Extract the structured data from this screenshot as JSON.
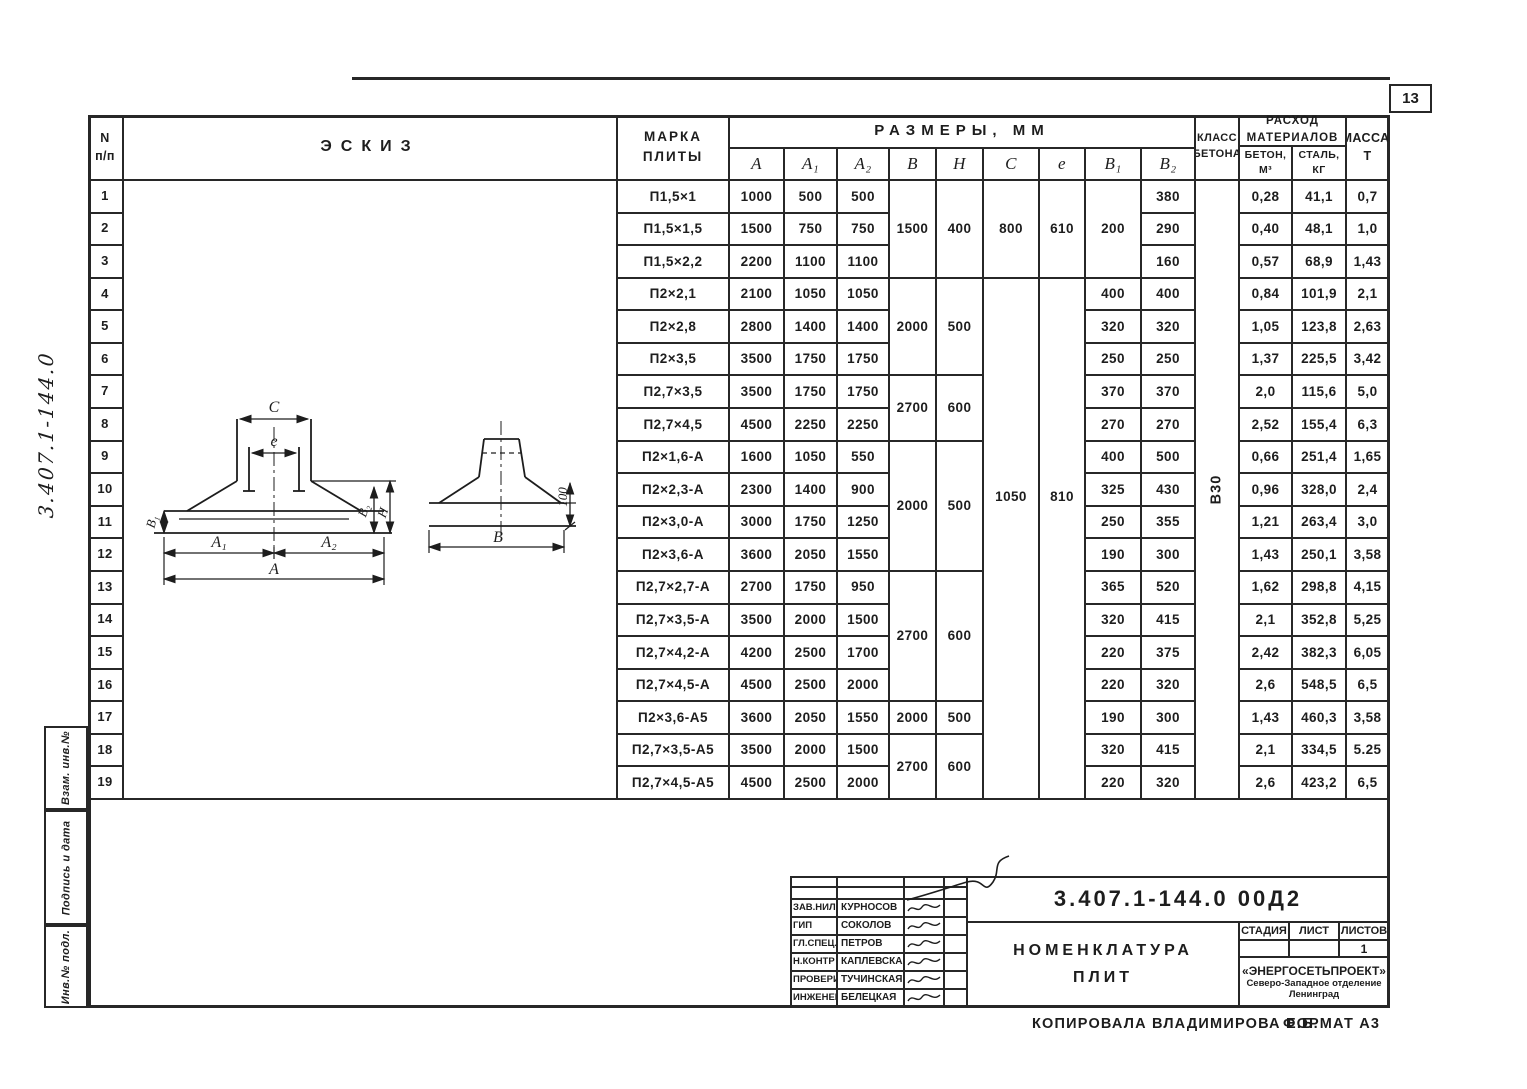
{
  "page": {
    "number": "13",
    "side_code": "3.407.1-144.0",
    "stamps": [
      "Взам. инв.№",
      "Подпись и дата",
      "Инв.№ подл."
    ],
    "copied": "КОПИРОВАЛА  ВЛАДИМИРОВА Е.Б.",
    "format": "ФОРМАТ А3"
  },
  "table": {
    "headers": {
      "num": [
        "N",
        "п/п"
      ],
      "sketch": "ЭСКИЗ",
      "mark": [
        "МАРКА",
        "ПЛИТЫ"
      ],
      "sizes_group": "РАЗМЕРЫ,  ММ",
      "size_cols": [
        "A",
        "A₁",
        "A₂",
        "B",
        "H",
        "C",
        "e",
        "B₁",
        "B₂"
      ],
      "class_col": [
        "КЛАСС",
        "БЕТОНА"
      ],
      "materials_group": [
        "РАСХОД",
        "МАТЕРИАЛОВ"
      ],
      "concrete_sub": [
        "БЕТОН,",
        "М³"
      ],
      "steel_sub": [
        "СТАЛЬ,",
        "КГ"
      ],
      "mass_col": [
        "МАССА,",
        "Т"
      ]
    },
    "rows": [
      {
        "n": "1",
        "mark": "П1,5×1",
        "a": "1000",
        "a1": "500",
        "a2": "500",
        "b2": "380",
        "concrete": "0,28",
        "steel": "41,1",
        "mass": "0,7"
      },
      {
        "n": "2",
        "mark": "П1,5×1,5",
        "a": "1500",
        "a1": "750",
        "a2": "750",
        "b2": "290",
        "concrete": "0,40",
        "steel": "48,1",
        "mass": "1,0"
      },
      {
        "n": "3",
        "mark": "П1,5×2,2",
        "a": "2200",
        "a1": "1100",
        "a2": "1100",
        "b2": "160",
        "concrete": "0,57",
        "steel": "68,9",
        "mass": "1,43"
      },
      {
        "n": "4",
        "mark": "П2×2,1",
        "a": "2100",
        "a1": "1050",
        "a2": "1050",
        "b1": "400",
        "b2": "400",
        "concrete": "0,84",
        "steel": "101,9",
        "mass": "2,1"
      },
      {
        "n": "5",
        "mark": "П2×2,8",
        "a": "2800",
        "a1": "1400",
        "a2": "1400",
        "b1": "320",
        "b2": "320",
        "concrete": "1,05",
        "steel": "123,8",
        "mass": "2,63"
      },
      {
        "n": "6",
        "mark": "П2×3,5",
        "a": "3500",
        "a1": "1750",
        "a2": "1750",
        "b1": "250",
        "b2": "250",
        "concrete": "1,37",
        "steel": "225,5",
        "mass": "3,42"
      },
      {
        "n": "7",
        "mark": "П2,7×3,5",
        "a": "3500",
        "a1": "1750",
        "a2": "1750",
        "b1": "370",
        "b2": "370",
        "concrete": "2,0",
        "steel": "115,6",
        "mass": "5,0"
      },
      {
        "n": "8",
        "mark": "П2,7×4,5",
        "a": "4500",
        "a1": "2250",
        "a2": "2250",
        "b1": "270",
        "b2": "270",
        "concrete": "2,52",
        "steel": "155,4",
        "mass": "6,3"
      },
      {
        "n": "9",
        "mark": "П2×1,6-А",
        "a": "1600",
        "a1": "1050",
        "a2": "550",
        "b1": "400",
        "b2": "500",
        "concrete": "0,66",
        "steel": "251,4",
        "mass": "1,65"
      },
      {
        "n": "10",
        "mark": "П2×2,3-А",
        "a": "2300",
        "a1": "1400",
        "a2": "900",
        "b1": "325",
        "b2": "430",
        "concrete": "0,96",
        "steel": "328,0",
        "mass": "2,4"
      },
      {
        "n": "11",
        "mark": "П2×3,0-А",
        "a": "3000",
        "a1": "1750",
        "a2": "1250",
        "b1": "250",
        "b2": "355",
        "concrete": "1,21",
        "steel": "263,4",
        "mass": "3,0"
      },
      {
        "n": "12",
        "mark": "П2×3,6-А",
        "a": "3600",
        "a1": "2050",
        "a2": "1550",
        "b1": "190",
        "b2": "300",
        "concrete": "1,43",
        "steel": "250,1",
        "mass": "3,58"
      },
      {
        "n": "13",
        "mark": "П2,7×2,7-А",
        "a": "2700",
        "a1": "1750",
        "a2": "950",
        "b1": "365",
        "b2": "520",
        "concrete": "1,62",
        "steel": "298,8",
        "mass": "4,15"
      },
      {
        "n": "14",
        "mark": "П2,7×3,5-А",
        "a": "3500",
        "a1": "2000",
        "a2": "1500",
        "b1": "320",
        "b2": "415",
        "concrete": "2,1",
        "steel": "352,8",
        "mass": "5,25"
      },
      {
        "n": "15",
        "mark": "П2,7×4,2-А",
        "a": "4200",
        "a1": "2500",
        "a2": "1700",
        "b1": "220",
        "b2": "375",
        "concrete": "2,42",
        "steel": "382,3",
        "mass": "6,05"
      },
      {
        "n": "16",
        "mark": "П2,7×4,5-А",
        "a": "4500",
        "a1": "2500",
        "a2": "2000",
        "b1": "220",
        "b2": "320",
        "concrete": "2,6",
        "steel": "548,5",
        "mass": "6,5"
      },
      {
        "n": "17",
        "mark": "П2×3,6-А5",
        "a": "3600",
        "a1": "2050",
        "a2": "1550",
        "b1": "190",
        "b2": "300",
        "concrete": "1,43",
        "steel": "460,3",
        "mass": "3,58"
      },
      {
        "n": "18",
        "mark": "П2,7×3,5-А5",
        "a": "3500",
        "a1": "2000",
        "a2": "1500",
        "b1": "320",
        "b2": "415",
        "concrete": "2,1",
        "steel": "334,5",
        "mass": "5.25"
      },
      {
        "n": "19",
        "mark": "П2,7×4,5-А5",
        "a": "4500",
        "a1": "2500",
        "a2": "2000",
        "b1": "220",
        "b2": "320",
        "concrete": "2,6",
        "steel": "423,2",
        "mass": "6,5"
      }
    ],
    "merged": {
      "bh_groups": [
        {
          "from": 1,
          "to": 3,
          "b": "1500",
          "h": "400"
        },
        {
          "from": 4,
          "to": 6,
          "b": "2000",
          "h": "500"
        },
        {
          "from": 7,
          "to": 8,
          "b": "2700",
          "h": "600"
        },
        {
          "from": 9,
          "to": 12,
          "b": "2000",
          "h": "500"
        },
        {
          "from": 13,
          "to": 16,
          "b": "2700",
          "h": "600"
        },
        {
          "from": 17,
          "to": 17,
          "b": "2000",
          "h": "500"
        },
        {
          "from": 18,
          "to": 19,
          "b": "2700",
          "h": "600"
        }
      ],
      "ce_groups": [
        {
          "from": 1,
          "to": 3,
          "c": "800",
          "e": "610"
        },
        {
          "from": 4,
          "to": 19,
          "c": "1050",
          "e": "810",
          "pad": 0.4
        }
      ],
      "b1_group": {
        "from": 1,
        "to": 3,
        "value": "200"
      },
      "concrete_class": "В30"
    }
  },
  "sketch_labels": {
    "c": "C",
    "e": "e",
    "b1": "B₁",
    "b2": "B₂",
    "h": "H",
    "a1": "A₁",
    "a2": "A₂",
    "a": "A",
    "b": "B",
    "lip": "100"
  },
  "title_block": {
    "doc_number": "3.407.1-144.0  00Д2",
    "title_line1": "НОМЕНКЛАТУРА",
    "title_line2": "ПЛИТ",
    "stage_label": "СТАДИЯ",
    "sheet_label": "ЛИСТ",
    "sheets_label": "ЛИСТОВ",
    "stage_value": "",
    "sheet_value": "",
    "sheets_value": "1",
    "org_name": "«ЭНЕРГОСЕТЬПРОЕКТ»",
    "org_sub1": "Северо-Западное отделение",
    "org_sub2": "Ленинград",
    "signatures": [
      {
        "role": "ЗАВ.НИЛКЭ",
        "name": "КУРНОСОВ"
      },
      {
        "role": "ГИП",
        "name": "СОКОЛОВ"
      },
      {
        "role": "ГЛ.СПЕЦ.",
        "name": "ПЕТРОВ"
      },
      {
        "role": "Н.КОНТР",
        "name": "КАПЛЕВСКАЯ"
      },
      {
        "role": "ПРОВЕРИЛА",
        "name": "ТУЧИНСКАЯ"
      },
      {
        "role": "ИНЖЕНЕР",
        "name": "БЕЛЕЦКАЯ"
      }
    ]
  }
}
